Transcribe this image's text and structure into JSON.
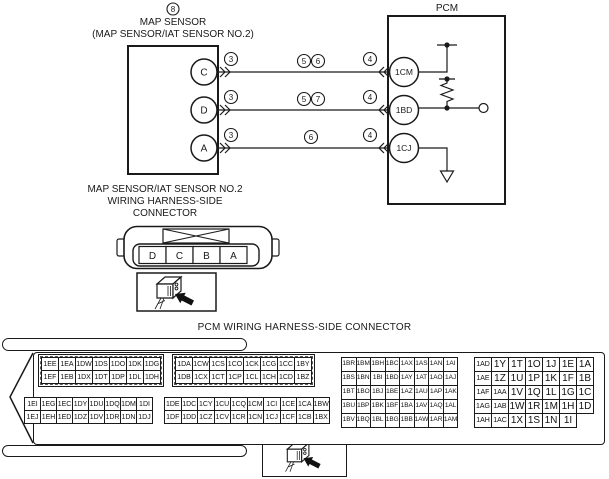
{
  "colors": {
    "line": "#1a1a1a",
    "background": "#ffffff",
    "arrow": "#111111"
  },
  "schematic": {
    "sensor": {
      "ref": "8",
      "name": "MAP SENSOR",
      "subname": "(MAP SENSOR/IAT SENSOR NO.2)",
      "terminals": [
        "C",
        "D",
        "A"
      ]
    },
    "pcm": {
      "name": "PCM",
      "terminals": [
        "1CM",
        "1BD",
        "1CJ"
      ]
    },
    "wires": [
      {
        "from": "C",
        "to": "1CM",
        "sensor_ref": "3",
        "mid_refs": [
          "5",
          "6"
        ],
        "pcm_ref": "4"
      },
      {
        "from": "D",
        "to": "1BD",
        "sensor_ref": "3",
        "mid_refs": [
          "5",
          "7"
        ],
        "pcm_ref": "4"
      },
      {
        "from": "A",
        "to": "1CJ",
        "sensor_ref": "3",
        "mid_refs": [
          "6"
        ],
        "pcm_ref": "4"
      }
    ]
  },
  "sensor_connector": {
    "label_line1": "MAP SENSOR/IAT SENSOR NO.2",
    "label_line2": "WIRING HARNESS-SIDE",
    "label_line3": "CONNECTOR",
    "pins": [
      "D",
      "C",
      "B",
      "A"
    ]
  },
  "pcm_connector": {
    "title": "PCM WIRING HARNESS-SIDE CONNECTOR",
    "blocks": [
      {
        "style": "scalloped",
        "rows": [
          [
            "1EE",
            "1EA",
            "1DW",
            "1DS",
            "1DO",
            "1DK",
            "1DG"
          ],
          [
            "1EF",
            "1EB",
            "1DX",
            "1DT",
            "1DP",
            "1DL",
            "1DH"
          ]
        ]
      },
      {
        "style": "scalloped",
        "rows": [
          [
            "1DA",
            "1CW",
            "1CS",
            "1CO",
            "1CK",
            "1CG",
            "1CC",
            "1BY"
          ],
          [
            "1DB",
            "1CX",
            "1CT",
            "1CP",
            "1CL",
            "1CH",
            "1CD",
            "1BZ"
          ]
        ]
      },
      {
        "style": "plain",
        "rows": [
          [
            "1EI",
            "1EG",
            "1EC",
            "1DY",
            "1DU",
            "1DQ",
            "1DM",
            "1DI"
          ],
          [
            "1EJ",
            "1EH",
            "1ED",
            "1DZ",
            "1DV",
            "1DR",
            "1DN",
            "1DJ"
          ]
        ]
      },
      {
        "style": "plain",
        "rows": [
          [
            "1DE",
            "1DC",
            "1CY",
            "1CU",
            "1CQ",
            "1CM",
            "1CI",
            "1CE",
            "1CA",
            "1BW"
          ],
          [
            "1DF",
            "1DD",
            "1CZ",
            "1CV",
            "1CR",
            "1CN",
            "1CJ",
            "1CF",
            "1CB",
            "1BX"
          ]
        ]
      },
      {
        "style": "plain",
        "rows": [
          [
            "1BR",
            "1BM",
            "1BH",
            "1BC",
            "1AX",
            "1AS",
            "1AN",
            "1AI"
          ],
          [
            "1BS",
            "1BN",
            "1BI",
            "1BD",
            "1AY",
            "1AT",
            "1AO",
            "1AJ"
          ],
          [
            "1BT",
            "1BO",
            "1BJ",
            "1BE",
            "1AZ",
            "1AU",
            "1AP",
            "1AK"
          ],
          [
            "1BU",
            "1BP",
            "1BK",
            "1BF",
            "1BA",
            "1AV",
            "1AQ",
            "1AL"
          ],
          [
            "1BV",
            "1BQ",
            "1BL",
            "1BG",
            "1BB",
            "1AW",
            "1AR",
            "1AM"
          ]
        ]
      },
      {
        "style": "plain",
        "rows": [
          [
            "1AD",
            "1Y",
            "1T",
            "1O",
            "1J",
            "1E",
            "1A"
          ],
          [
            "1AE",
            "1Z",
            "1U",
            "1P",
            "1K",
            "1F",
            "1B"
          ],
          [
            "1AF",
            "1AA",
            "1V",
            "1Q",
            "1L",
            "1G",
            "1C"
          ],
          [
            "1AG",
            "1AB",
            "1W",
            "1R",
            "1M",
            "1H",
            "1D"
          ],
          [
            "1AH",
            "1AC",
            "1X",
            "1S",
            "1N",
            "1I"
          ]
        ]
      }
    ]
  }
}
